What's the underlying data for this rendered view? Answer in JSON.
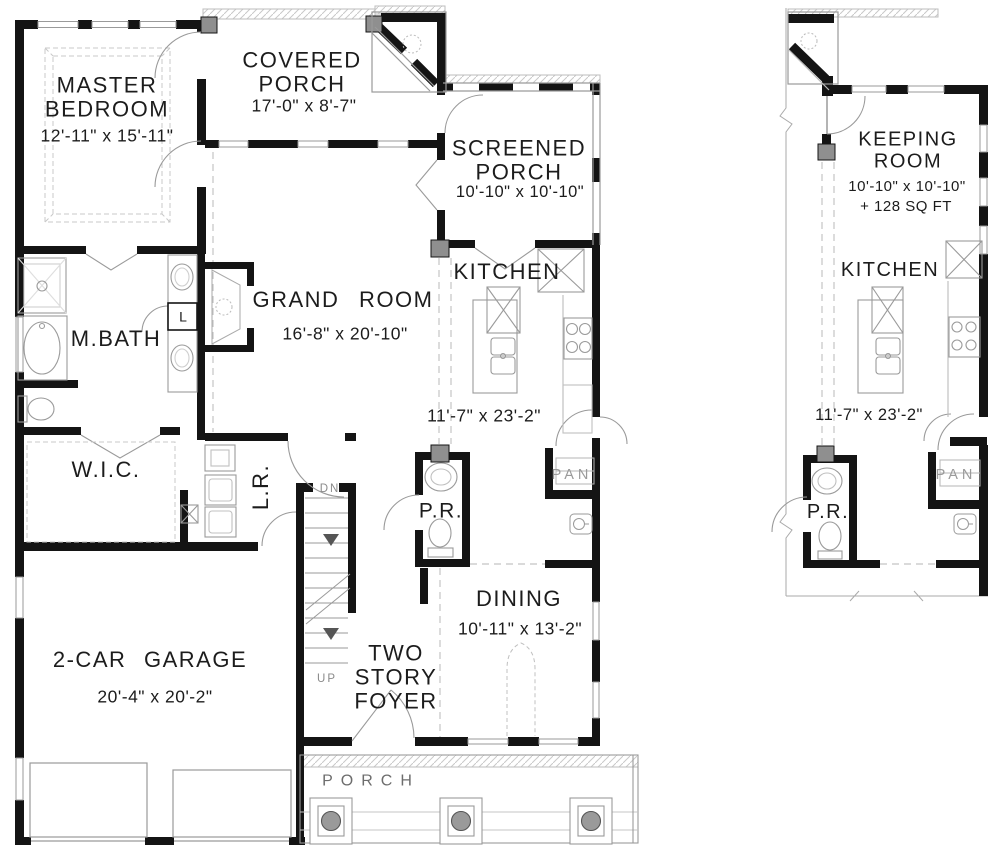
{
  "plan": {
    "main": {
      "master_bedroom": {
        "name": "MASTER BEDROOM",
        "dims": "12'-11\" x 15'-11\""
      },
      "covered_porch": {
        "name": "COVERED PORCH",
        "dims": "17'-0\" x 8'-7\""
      },
      "screened_porch": {
        "name": "SCREENED PORCH",
        "dims": "10'-10\" x 10'-10\""
      },
      "grand_room": {
        "name": "GRAND ROOM",
        "dims": "16'-8\" x 20'-10\""
      },
      "kitchen": {
        "name": "KITCHEN",
        "dims": "11'-7\" x 23'-2\""
      },
      "master_bath": {
        "name": "M.BATH"
      },
      "walk_in_closet": {
        "name": "W.I.C."
      },
      "laundry_room": {
        "name": "L.R."
      },
      "powder_room": {
        "name": "P.R."
      },
      "pantry": {
        "name": "PAN"
      },
      "linen_closet": {
        "name": "L"
      },
      "dining": {
        "name": "DINING",
        "dims": "10'-11\" x 13'-2\""
      },
      "foyer": {
        "name": "TWO STORY FOYER"
      },
      "garage": {
        "name": "2-CAR GARAGE",
        "dims": "20'-4\" x 20'-2\""
      },
      "porch": {
        "name": "PORCH"
      },
      "stairs": {
        "down": "DN",
        "up": "UP"
      }
    },
    "alternate": {
      "keeping_room": {
        "name": "KEEPING ROOM",
        "dims": "10'-10\" x 10'-10\"",
        "area": "+ 128 SQ FT"
      },
      "kitchen": {
        "name": "KITCHEN",
        "dims": "11'-7\" x 23'-2\""
      },
      "powder_room": {
        "name": "P.R."
      },
      "pantry": {
        "name": "PAN"
      }
    },
    "colors": {
      "wall": "#141414",
      "thin_line": "#9a9a9a",
      "dashed_line": "#c4c4c4",
      "post_fill": "#8f8f8f",
      "text": "#1c1c1c",
      "muted_text": "#8a8a8a"
    }
  }
}
